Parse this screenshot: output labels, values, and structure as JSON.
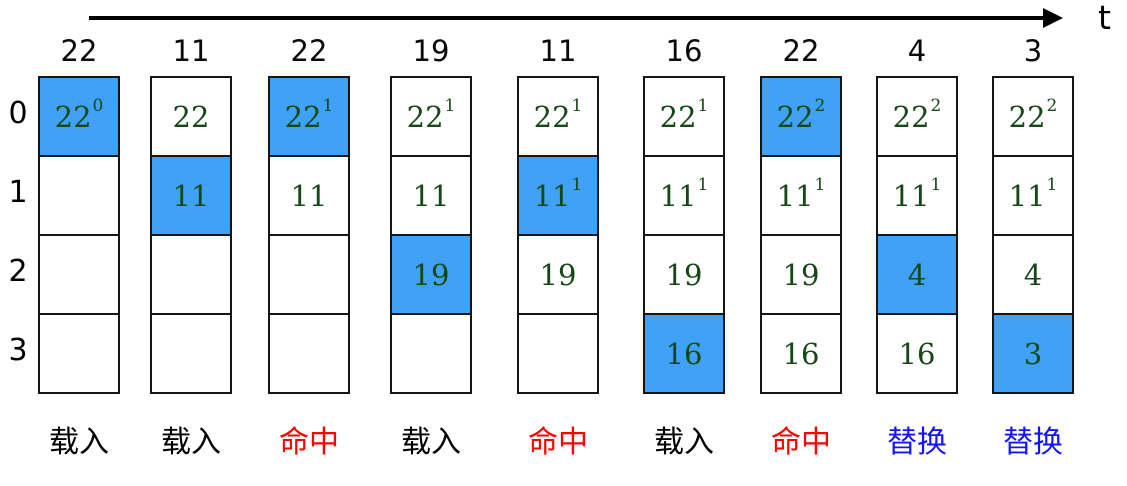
{
  "timeline": {
    "label": "t"
  },
  "frame_labels": [
    "0",
    "1",
    "2",
    "3"
  ],
  "colors": {
    "highlight": "#3FA2F7",
    "cell_text": "#164716",
    "load": "#000000",
    "hit": "#FE0000",
    "replace": "#1414FE"
  },
  "columns": [
    {
      "ref": "22",
      "action": "载入",
      "action_type": "load",
      "cells": [
        {
          "value": "22",
          "sup": "0",
          "highlight": true
        },
        {
          "value": "",
          "sup": "",
          "highlight": false
        },
        {
          "value": "",
          "sup": "",
          "highlight": false
        },
        {
          "value": "",
          "sup": "",
          "highlight": false
        }
      ]
    },
    {
      "ref": "11",
      "action": "载入",
      "action_type": "load",
      "cells": [
        {
          "value": "22",
          "sup": "",
          "highlight": false
        },
        {
          "value": "11",
          "sup": "",
          "highlight": true
        },
        {
          "value": "",
          "sup": "",
          "highlight": false
        },
        {
          "value": "",
          "sup": "",
          "highlight": false
        }
      ]
    },
    {
      "ref": "22",
      "action": "命中",
      "action_type": "hit",
      "cells": [
        {
          "value": "22",
          "sup": "1",
          "highlight": true
        },
        {
          "value": "11",
          "sup": "",
          "highlight": false
        },
        {
          "value": "",
          "sup": "",
          "highlight": false
        },
        {
          "value": "",
          "sup": "",
          "highlight": false
        }
      ]
    },
    {
      "ref": "19",
      "action": "载入",
      "action_type": "load",
      "cells": [
        {
          "value": "22",
          "sup": "1",
          "highlight": false
        },
        {
          "value": "11",
          "sup": "",
          "highlight": false
        },
        {
          "value": "19",
          "sup": "",
          "highlight": true
        },
        {
          "value": "",
          "sup": "",
          "highlight": false
        }
      ]
    },
    {
      "ref": "11",
      "action": "命中",
      "action_type": "hit",
      "cells": [
        {
          "value": "22",
          "sup": "1",
          "highlight": false
        },
        {
          "value": "11",
          "sup": "1",
          "highlight": true
        },
        {
          "value": "19",
          "sup": "",
          "highlight": false
        },
        {
          "value": "",
          "sup": "",
          "highlight": false
        }
      ]
    },
    {
      "ref": "16",
      "action": "载入",
      "action_type": "load",
      "cells": [
        {
          "value": "22",
          "sup": "1",
          "highlight": false
        },
        {
          "value": "11",
          "sup": "1",
          "highlight": false
        },
        {
          "value": "19",
          "sup": "",
          "highlight": false
        },
        {
          "value": "16",
          "sup": "",
          "highlight": true
        }
      ]
    },
    {
      "ref": "22",
      "action": "命中",
      "action_type": "hit",
      "cells": [
        {
          "value": "22",
          "sup": "2",
          "highlight": true
        },
        {
          "value": "11",
          "sup": "1",
          "highlight": false
        },
        {
          "value": "19",
          "sup": "",
          "highlight": false
        },
        {
          "value": "16",
          "sup": "",
          "highlight": false
        }
      ]
    },
    {
      "ref": "4",
      "action": "替换",
      "action_type": "replace",
      "cells": [
        {
          "value": "22",
          "sup": "2",
          "highlight": false
        },
        {
          "value": "11",
          "sup": "1",
          "highlight": false
        },
        {
          "value": "4",
          "sup": "",
          "highlight": true
        },
        {
          "value": "16",
          "sup": "",
          "highlight": false
        }
      ]
    },
    {
      "ref": "3",
      "action": "替换",
      "action_type": "replace",
      "cells": [
        {
          "value": "22",
          "sup": "2",
          "highlight": false
        },
        {
          "value": "11",
          "sup": "1",
          "highlight": false
        },
        {
          "value": "4",
          "sup": "",
          "highlight": false
        },
        {
          "value": "3",
          "sup": "",
          "highlight": true
        }
      ]
    }
  ]
}
